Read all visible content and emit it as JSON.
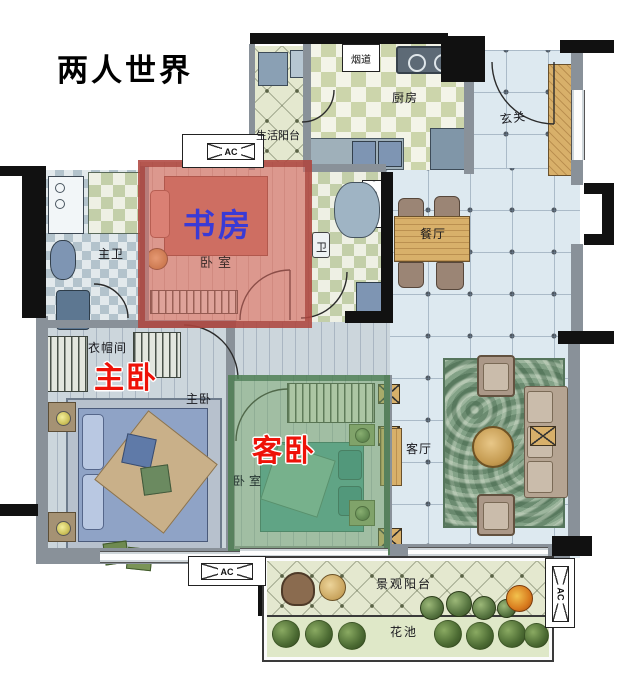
{
  "title": "两人世界",
  "annotations": {
    "study": "书房",
    "master": "主卧",
    "guest": "客卧"
  },
  "room_labels": {
    "life_balcony": "生活阳台",
    "kitchen": "厨房",
    "flue": "烟道",
    "entry": "玄关",
    "dining": "餐厅",
    "master_bath": "主卫",
    "bath": "卫",
    "study_bedroom": "卧室",
    "cloakroom": "衣帽间",
    "master_bedroom_small": "主卧",
    "guest_bedroom": "卧室",
    "living": "客厅",
    "view_balcony": "景观阳台",
    "flower_bed": "花池"
  },
  "ac_units": {
    "top": "AC",
    "bottom": "AC",
    "right": "AC"
  },
  "colors": {
    "annotation_red": "#ee1208",
    "annotation_blue": "#3a3ad6",
    "study_overlay": "#dc6c60",
    "guest_overlay": "#76a66a",
    "wall_black": "#111111",
    "wall_gray": "#899199",
    "open_floor": "#dde9f0",
    "wood": "#d8b06a",
    "rug_green": "#83a287"
  }
}
